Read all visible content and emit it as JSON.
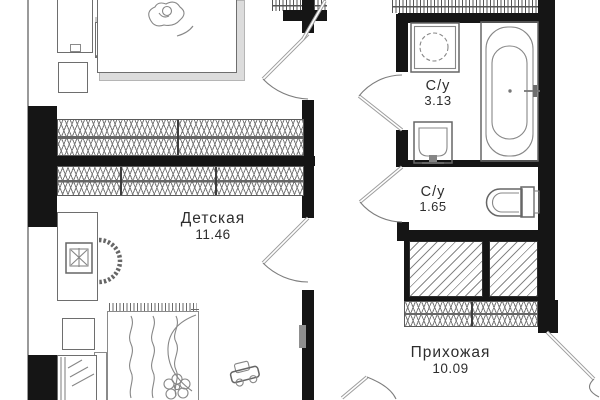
{
  "rooms": [
    {
      "name": "Детская",
      "area": "11.46"
    },
    {
      "name": "С/у",
      "area": "3.13"
    },
    {
      "name": "С/у",
      "area": "1.65"
    },
    {
      "name": "Прихожая",
      "area": "10.09"
    }
  ],
  "colors": {
    "wall": "#151515",
    "furniture_line": "#6e6e6e",
    "shadow": "#dcdcdc",
    "text": "#2d2d2d",
    "background": "#ffffff"
  }
}
